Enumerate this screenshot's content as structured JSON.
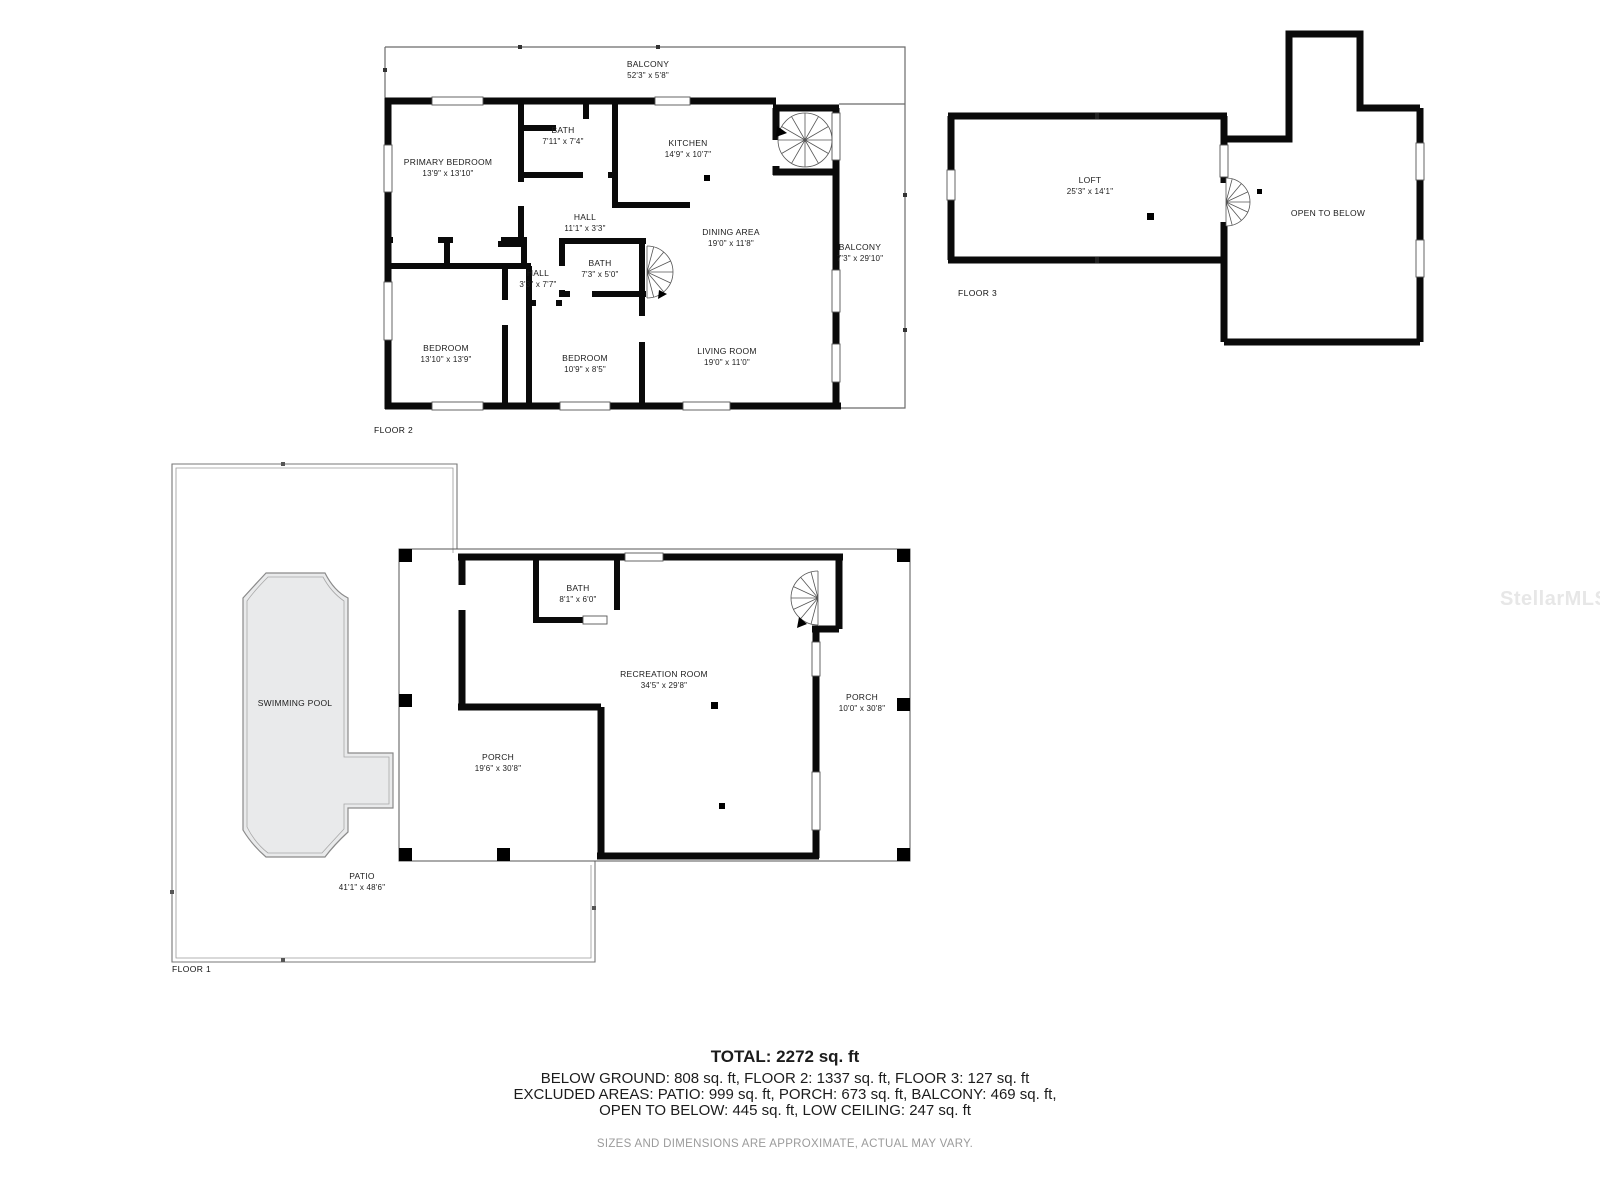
{
  "colors": {
    "wall": "#0a0a0a",
    "thin_line": "#666666",
    "pool_fill": "#e9eaeb",
    "text": "#1c1c1c",
    "muted_text": "#9b9b9b",
    "watermark": "#e7e7e7"
  },
  "floor2": {
    "label": "FLOOR 2",
    "rooms": [
      {
        "name": "BALCONY",
        "dims": "52'3\" x 5'8\""
      },
      {
        "name": "PRIMARY BEDROOM",
        "dims": "13'9\" x 13'10\""
      },
      {
        "name": "BATH",
        "dims": "7'11\" x 7'4\""
      },
      {
        "name": "KITCHEN",
        "dims": "14'9\" x 10'7\""
      },
      {
        "name": "HALL",
        "dims": "11'1\" x 3'3\""
      },
      {
        "name": "DINING AREA",
        "dims": "19'0\" x 11'8\""
      },
      {
        "name": "BALCONY",
        "dims": "7'3\" x 29'10\""
      },
      {
        "name": "BATH",
        "dims": "7'3\" x 5'0\""
      },
      {
        "name": "HALL",
        "dims": "3'3\" x 7'7\""
      },
      {
        "name": "BEDROOM",
        "dims": "13'10\" x 13'9\""
      },
      {
        "name": "BEDROOM",
        "dims": "10'9\" x 8'5\""
      },
      {
        "name": "LIVING ROOM",
        "dims": "19'0\" x 11'0\""
      }
    ]
  },
  "floor3": {
    "label": "FLOOR 3",
    "rooms": [
      {
        "name": "LOFT",
        "dims": "25'3\" x 14'1\""
      },
      {
        "name": "OPEN TO BELOW",
        "dims": ""
      }
    ]
  },
  "floor1": {
    "label": "FLOOR 1",
    "rooms": [
      {
        "name": "SWIMMING POOL",
        "dims": ""
      },
      {
        "name": "PATIO",
        "dims": "41'1\" x 48'6\""
      },
      {
        "name": "BATH",
        "dims": "8'1\" x 6'0\""
      },
      {
        "name": "RECREATION ROOM",
        "dims": "34'5\" x 29'8\""
      },
      {
        "name": "PORCH",
        "dims": "19'6\" x 30'8\""
      },
      {
        "name": "PORCH",
        "dims": "10'0\" x 30'8\""
      }
    ]
  },
  "summary": {
    "total": "TOTAL: 2272 sq. ft",
    "line2": "BELOW GROUND: 808 sq. ft, FLOOR 2: 1337 sq. ft, FLOOR 3: 127 sq. ft",
    "line3": "EXCLUDED AREAS: PATIO: 999 sq. ft, PORCH: 673 sq. ft, BALCONY: 469 sq. ft,",
    "line4": "OPEN TO BELOW: 445 sq. ft, LOW CEILING: 247 sq. ft",
    "disclaimer": "SIZES AND DIMENSIONS ARE APPROXIMATE, ACTUAL MAY VARY."
  },
  "watermark": "StellarMLS"
}
